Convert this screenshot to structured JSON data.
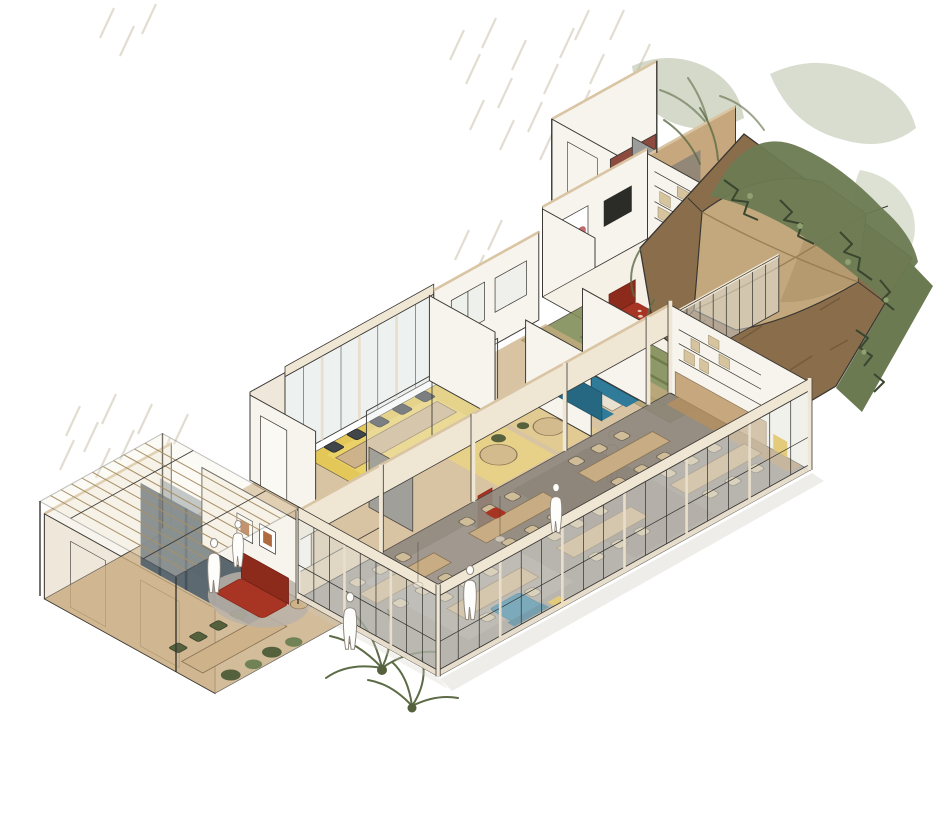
{
  "canvas": {
    "width": 935,
    "height": 836
  },
  "palette": {
    "paper": "#ffffff",
    "ink": "#3a3733",
    "wall_white": "#f7f4ed",
    "wall_cream": "#efe8da",
    "wall_top": "#d9c5a3",
    "wood": "#c7a87e",
    "wood_dark": "#b08f63",
    "floor_wood": "#c9ac80",
    "floor_dining": "#90867a",
    "floor_yellow": "#e5c84d",
    "glow_yellow": "#f6dd6e",
    "floor_green": "#7f8b55",
    "dirt": "#8a6e4b",
    "hedge": "#6c7a52",
    "hedge_dark": "#3a462f",
    "sage": "#a9b494",
    "canopy": "#c4a87d",
    "canopy_shade": "#ab8f66",
    "curtain": "#56646e",
    "curtain_light": "#6b7a84",
    "red": "#a83524",
    "red_dark": "#8c2a1c",
    "maroon": "#8d4b40",
    "grey_panel": "#9c9c9a",
    "teal": "#2f7b99",
    "teal_dark": "#266781",
    "wicker": "#cfbd9a",
    "chair_dark": "#41464a",
    "olive": "#55603c",
    "glass": "#e7ecea",
    "rug": "#b9b2a8",
    "heart": "#c96a6f",
    "fascia": "#efe6d4",
    "crate": "#2f5d33",
    "accent_yellow": "#e0b32c",
    "shadow": "#cfccc2",
    "figure": "#fdfdfb",
    "hatch": "#d8d2c4",
    "apron": "#75591f"
  },
  "scene": {
    "type": "hand-drawn axonometric interior cutaway sketch",
    "areas": [
      "pergola-lounge",
      "curtain-lounge",
      "reading-nook",
      "meeting-room",
      "corridor",
      "booth-seating",
      "dining-hall",
      "green-hall",
      "sitting-room",
      "wc-block",
      "garden-courtyard"
    ],
    "furniture": [
      "long-dining-tables",
      "wicker-chairs",
      "meeting-table",
      "office-chairs",
      "red-sofa",
      "round-rug",
      "teal-booth",
      "teal-sofa",
      "red-armchair",
      "canopy-sail",
      "planting-crate",
      "curtains",
      "shelving",
      "round-cafe-tables",
      "floor-plants",
      "hedges"
    ],
    "figure_count": 6
  }
}
